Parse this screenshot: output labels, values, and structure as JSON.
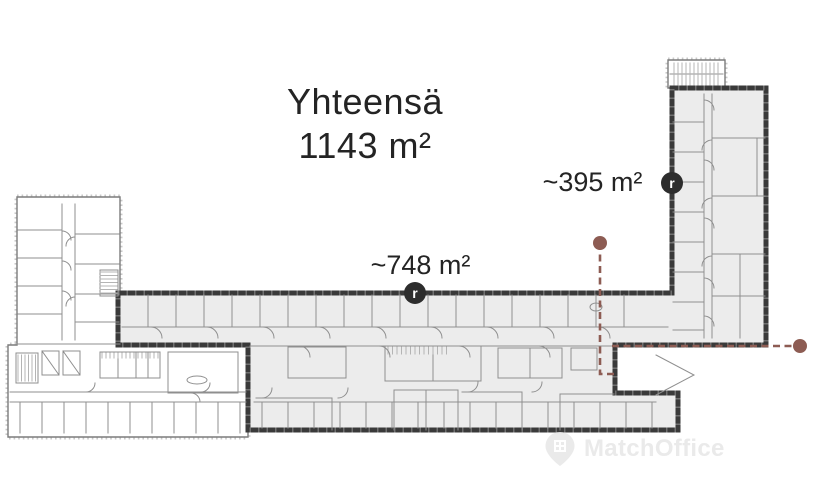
{
  "page": {
    "width": 825,
    "height": 500
  },
  "title": {
    "line1": "Yhteensä",
    "line2": "1143 m²"
  },
  "areas": [
    {
      "label": "~748 m²",
      "marker_glyph": "r"
    },
    {
      "label": "~395 m²",
      "marker_glyph": "r"
    }
  ],
  "watermark": {
    "brand": "MatchOffice"
  },
  "colors": {
    "highlight_fill": "#ececec",
    "highlight_border": "#3a3a3a",
    "plan_line": "#8f8f8f",
    "plan_line_light": "#b4b4b4",
    "accent_route": "#8d5c53",
    "marker_bg": "#2d2d2d",
    "marker_text": "#ffffff",
    "title_text": "#242424",
    "watermark_text": "#e7e7e7"
  }
}
